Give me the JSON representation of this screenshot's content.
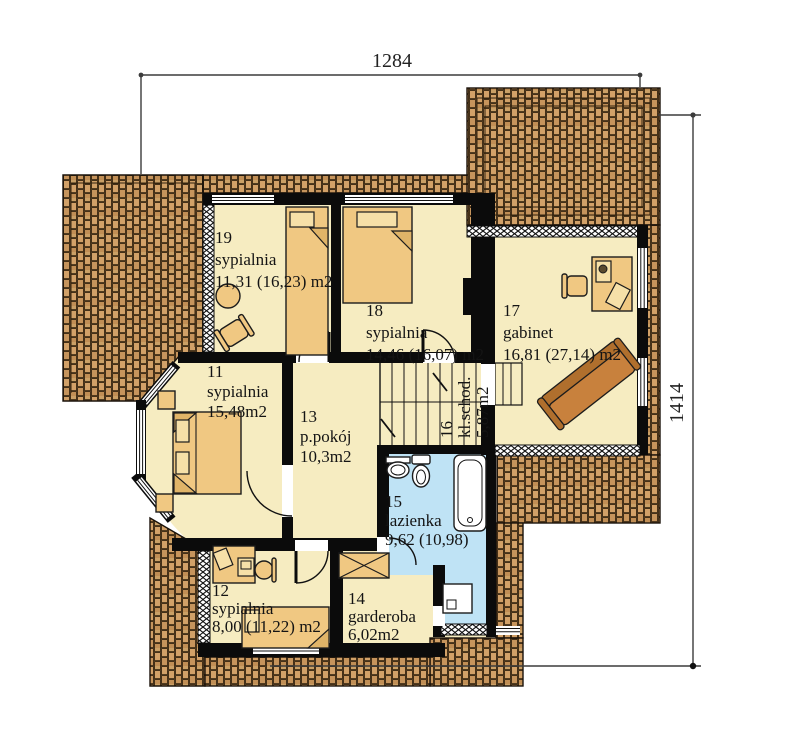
{
  "plan_title": "first-floor-plan",
  "dimensions": {
    "width": "1284",
    "height": "1414"
  },
  "rooms": [
    {
      "id": "19",
      "name": "sypialnia",
      "area": "11,31 (16,23) m2"
    },
    {
      "id": "18",
      "name": "sypialnia",
      "area": "14,46 (16,07) m2"
    },
    {
      "id": "17",
      "name": "gabinet",
      "area": "16,81 (27,14) m2"
    },
    {
      "id": "11",
      "name": "sypialnia",
      "area": "15,48m2"
    },
    {
      "id": "13",
      "name": "p.pokój",
      "area": "10,3m2"
    },
    {
      "id": "16",
      "name": "kl.schod.",
      "area": "5,87m2"
    },
    {
      "id": "15",
      "name": "lazienka",
      "area": "9,62 (10,98)"
    },
    {
      "id": "12",
      "name": "sypialnia",
      "area": "8,00 (11,22) m2"
    },
    {
      "id": "14",
      "name": "garderoba",
      "area": "6,02m2"
    }
  ],
  "colors": {
    "floor": "#f6ecc1",
    "bathroom_floor": "#bfe3f5",
    "roof_tile": "#d2a168",
    "roof_joint": "#33240f",
    "wall": "#0b0b0b",
    "furniture": "#f0c882",
    "sofa": "#c8813d",
    "dimension_line": "#3c3c3c"
  }
}
